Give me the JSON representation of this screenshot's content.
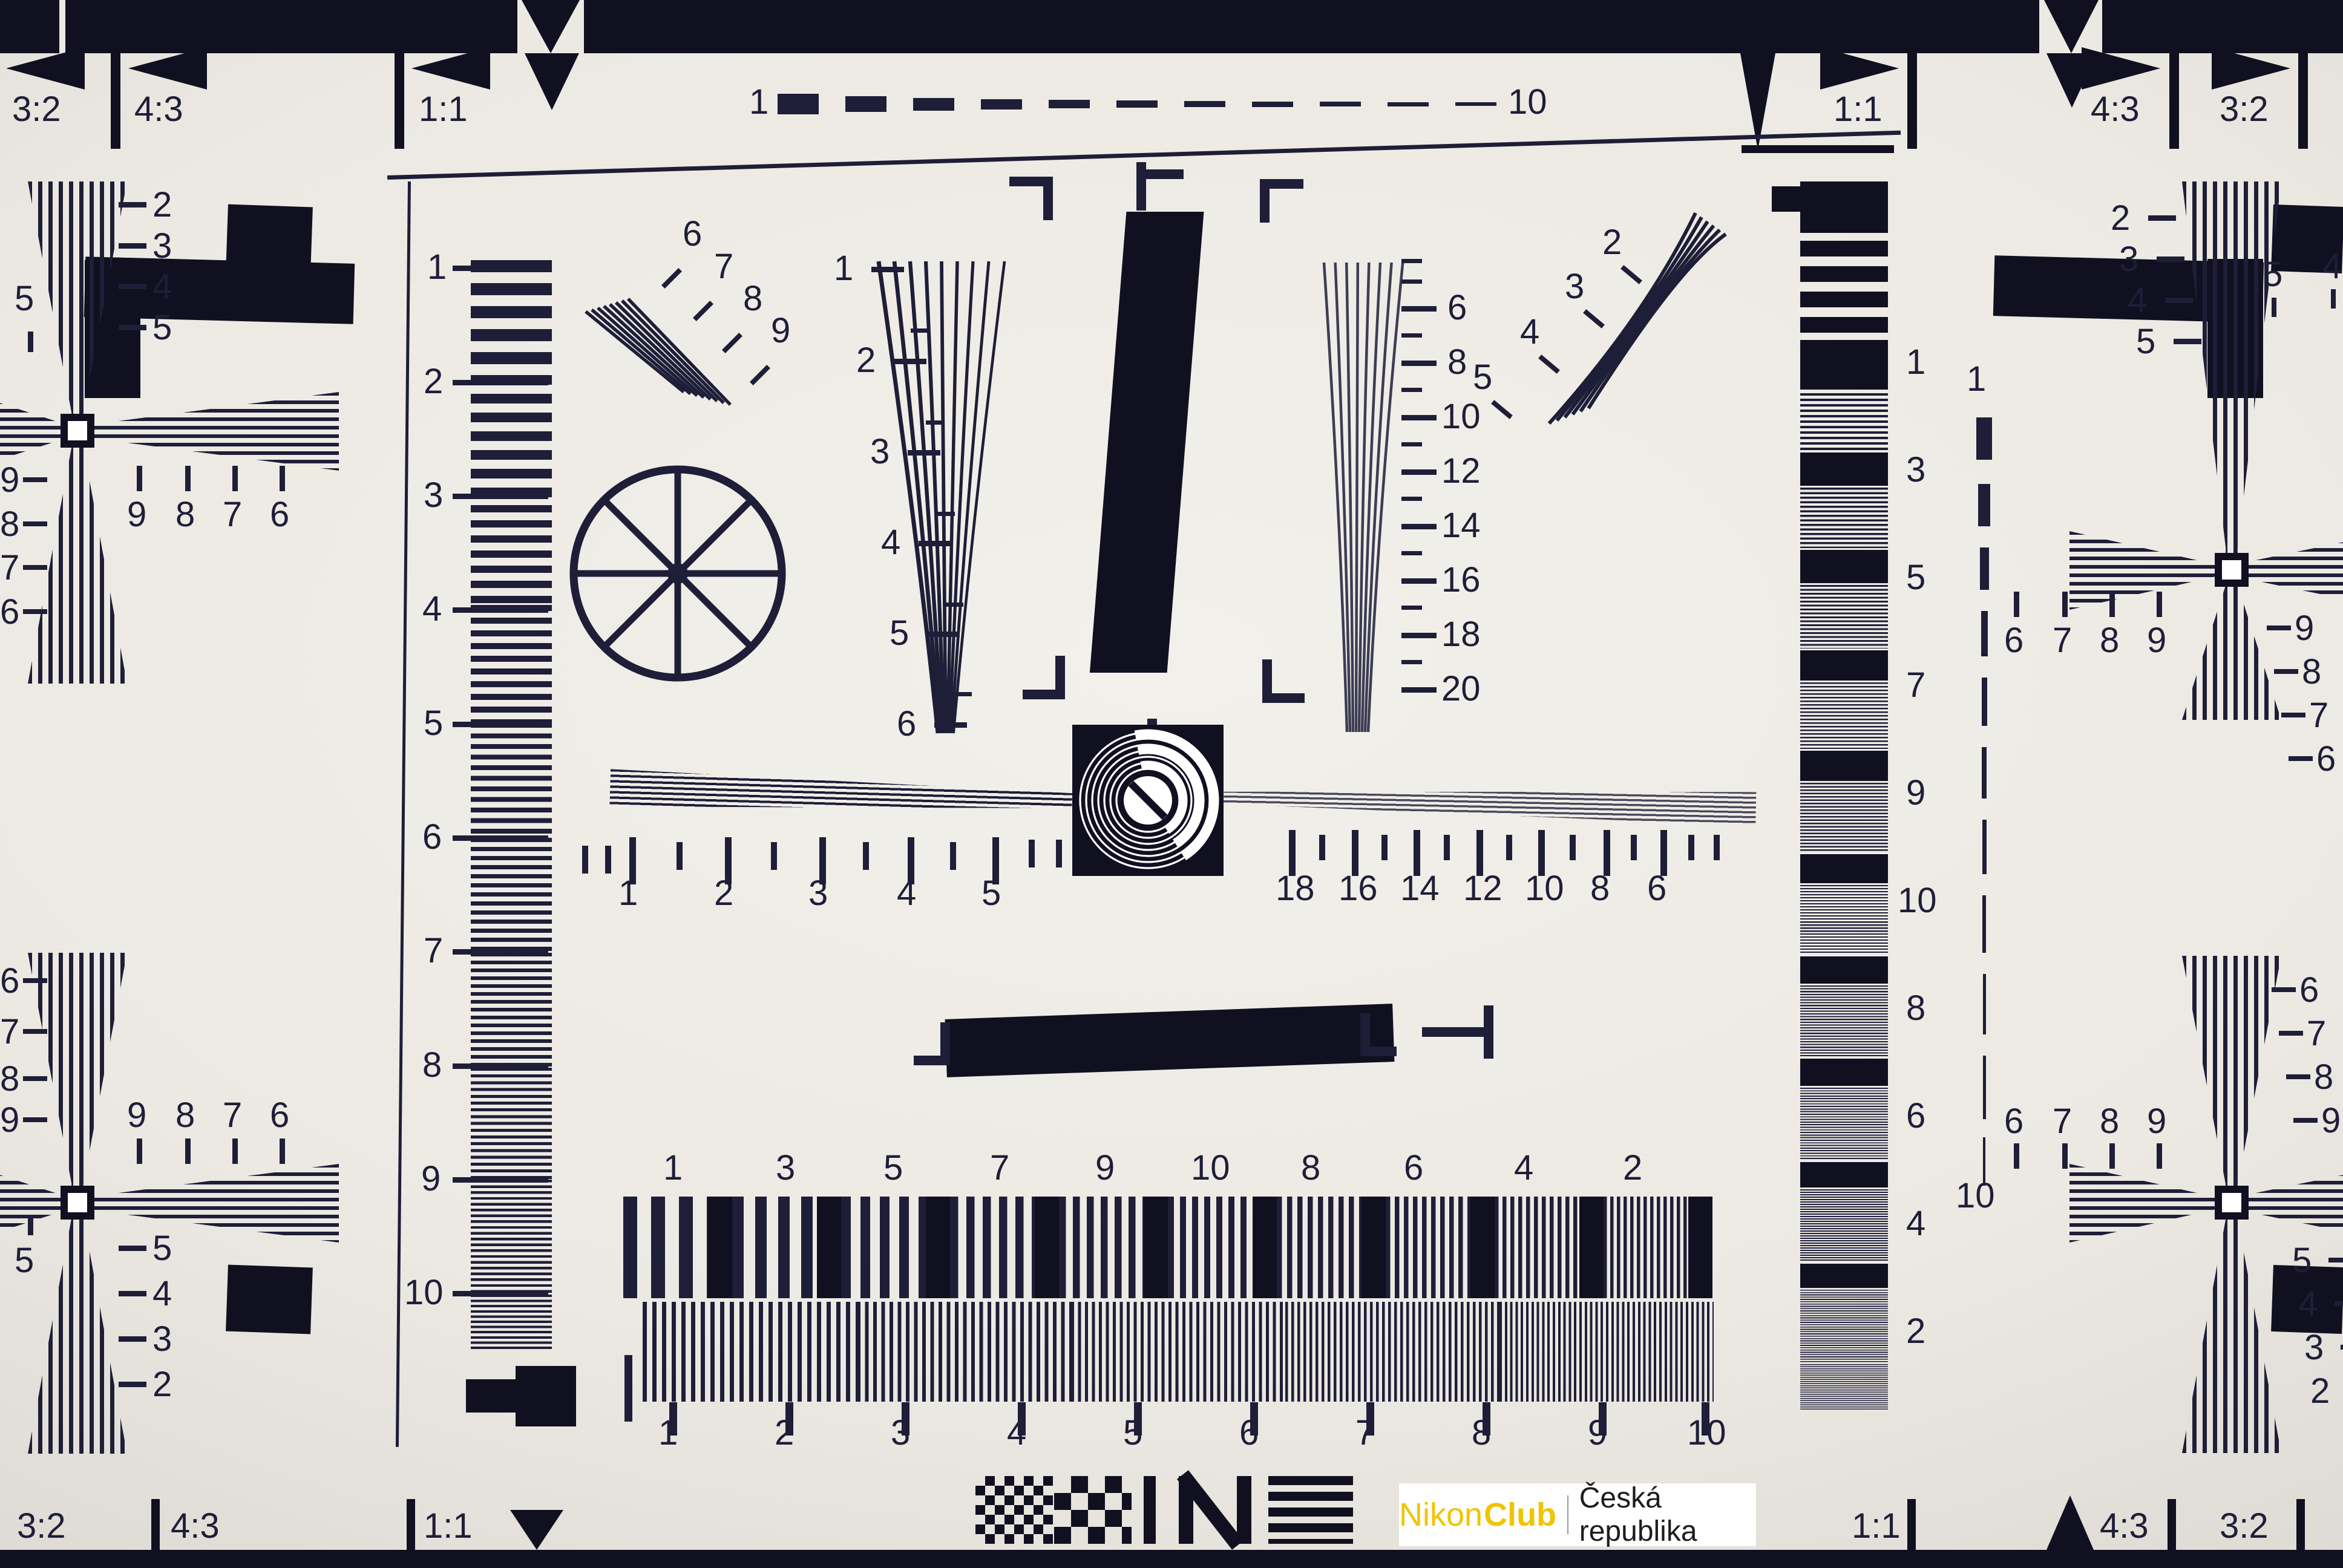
{
  "chart_title": "resolution-test-chart",
  "colors": {
    "ink": "#1e1e38",
    "black": "#101020",
    "paper": "#ece9e3",
    "yellow": "#f0c400",
    "grey_wedge": "#4a4a5e"
  },
  "top_edge": {
    "markers_left": [
      "3:2",
      "4:3",
      "1:1"
    ],
    "markers_right": [
      "1:1",
      "4:3",
      "3:2"
    ],
    "dash_scale": {
      "start": "1",
      "end": "10"
    }
  },
  "bottom_edge": {
    "markers_left": [
      "3:2",
      "4:3",
      "1:1"
    ],
    "markers_right": [
      "1:1",
      "4:3",
      "3:2"
    ]
  },
  "left_ruler": {
    "labels": [
      "1",
      "2",
      "3",
      "4",
      "5",
      "6",
      "7",
      "8",
      "9",
      "10"
    ]
  },
  "center_wedge": {
    "labels": [
      "1",
      "2",
      "3",
      "4",
      "5",
      "6"
    ]
  },
  "diag_wedge": {
    "labels": [
      "6",
      "7",
      "8",
      "9"
    ]
  },
  "right_wedge": {
    "labels": [
      "6",
      "8",
      "10",
      "12",
      "14",
      "16",
      "18",
      "20"
    ]
  },
  "fan_wedge": {
    "labels": [
      "2",
      "3",
      "4",
      "5"
    ]
  },
  "h_scale_left": {
    "labels": [
      "1",
      "2",
      "3",
      "4",
      "5"
    ]
  },
  "h_scale_right": {
    "labels": [
      "18",
      "16",
      "14",
      "12",
      "10",
      "8",
      "6"
    ]
  },
  "right_column": {
    "labels": [
      "1",
      "3",
      "5",
      "7",
      "9",
      "10",
      "8",
      "6",
      "4",
      "2"
    ]
  },
  "dash_column": {
    "top": "1",
    "bottom": "10"
  },
  "bottom_bars": {
    "top_labels": [
      "1",
      "3",
      "5",
      "7",
      "9",
      "10",
      "8",
      "6",
      "4",
      "2"
    ],
    "bottom_labels": [
      "1",
      "2",
      "3",
      "4",
      "5",
      "6",
      "7",
      "8",
      "9",
      "10"
    ]
  },
  "cross_left_top": {
    "v_labels": [
      "2",
      "3",
      "4",
      "5"
    ],
    "h_labels": [
      "9",
      "8",
      "7",
      "6"
    ],
    "edge_label": "5",
    "edge_col": [
      "9",
      "8",
      "7",
      "6"
    ]
  },
  "cross_left_bottom": {
    "h_labels": [
      "9",
      "8",
      "7",
      "6"
    ],
    "v_labels": [
      "5",
      "4",
      "3",
      "2"
    ],
    "edge_label": "5",
    "edge_col": [
      "6",
      "7",
      "8",
      "9"
    ]
  },
  "cross_right_top": {
    "v_labels": [
      "2",
      "3",
      "4",
      "5"
    ],
    "h_labels": [
      "6",
      "7",
      "8",
      "9"
    ],
    "side_col": [
      "9",
      "8",
      "7",
      "6"
    ],
    "edge_pair": [
      "5",
      "4"
    ]
  },
  "cross_right_bottom": {
    "h_labels": [
      "6",
      "7",
      "8",
      "9"
    ],
    "side_col": [
      "6",
      "7",
      "8",
      "9"
    ],
    "v_labels": [
      "5",
      "4",
      "3",
      "2"
    ]
  },
  "watermark": {
    "brand_regular": "Nikon",
    "brand_bold": "Club",
    "region": "Česká republika"
  }
}
